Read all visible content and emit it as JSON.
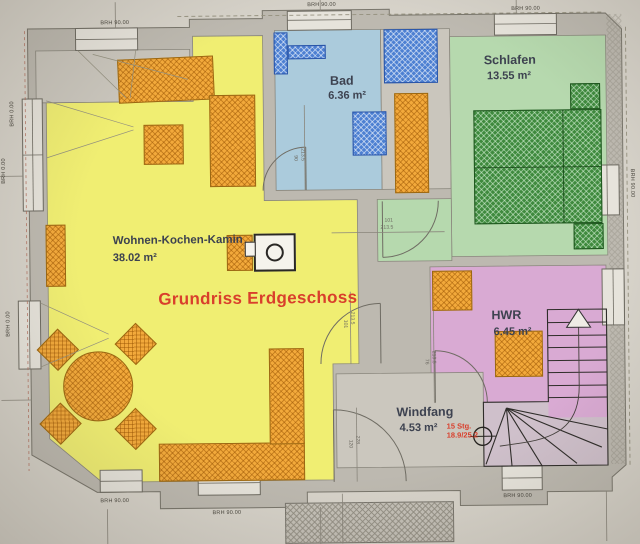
{
  "colors": {
    "paper": "#d7d3ca",
    "wall": "#bdb9b0",
    "floor": "#cac6bd",
    "wohnen": "#f0ee72",
    "bad": "#abcbdc",
    "schlafen": "#b6d9ae",
    "hwr": "#d9aad3",
    "windfang": "#cbc7be",
    "orange": "#f2a93b",
    "blue": "#4d80d2",
    "bed": "#3f8a3e",
    "red": "#d93f2c",
    "label": "#3d4250"
  },
  "title": {
    "text": "Grundriss Erdgeschoss"
  },
  "rooms": {
    "wohnen": {
      "name": "Wohnen-Kochen-Kamin",
      "area": "38.02 m²"
    },
    "bad": {
      "name": "Bad",
      "area": "6.36 m²"
    },
    "schlafen": {
      "name": "Schlafen",
      "area": "13.55 m²"
    },
    "hwr": {
      "name": "HWR",
      "area": "6.45 m²"
    },
    "windfang": {
      "name": "Windfang",
      "area": "4.53 m²"
    }
  },
  "stairs": {
    "note_line1": "15 Stg.",
    "note_line2": "18.9/25.2"
  },
  "sills": {
    "top_left": "BRH 90.00",
    "top_middle": "BRH 90.00",
    "top_right": "BRH 90.00",
    "right": "BRH 90.00",
    "left_upper": "BRH 0.00",
    "left_middle": "BRH 0.00",
    "left_lower": "BRH 0.00",
    "bottom_left": "BRH 90.00",
    "bottom_middle": "BRH 90.00",
    "bottom_right": "BRH 90.00"
  },
  "doors": {
    "bad": {
      "w": "90",
      "h": "213.5"
    },
    "schlafen": {
      "w": "101",
      "h": "213.5"
    },
    "wohnen_windfang": {
      "w": "101",
      "h": "213.5"
    },
    "hwr": {
      "w": "76",
      "h": "213.5"
    },
    "entrance": {
      "w": "120",
      "h": "228"
    }
  }
}
